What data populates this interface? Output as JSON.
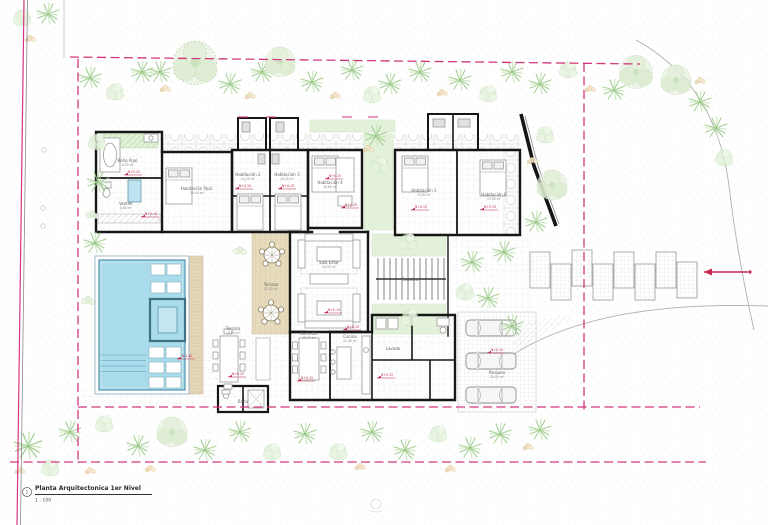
{
  "title_block": {
    "number": "1",
    "title": "Planta Arquitectonica 1er Nivel",
    "scale": "1 : 100"
  },
  "colors": {
    "boundary_pink": "#d2377e",
    "wall_black": "#161616",
    "pool_water": "#aadbea",
    "pool_edge": "#5d99b0",
    "vegetation_green": "#b3d6a3",
    "vegetation_light": "#ddeed3",
    "deck_wood": "#e6dabc",
    "marker_red": "#c42a4d",
    "furniture_gray": "#9b9b9b",
    "tile_gray": "#dedede"
  },
  "plan": {
    "rooms": [
      {
        "name": "Baño Ppal.",
        "area": "6.20 m²",
        "x": 128,
        "y": 162
      },
      {
        "name": "Vestier",
        "area": "4.80 m²",
        "x": 126,
        "y": 205
      },
      {
        "name": "Habitación Ppal.",
        "area": "18.40 m²",
        "x": 197,
        "y": 190
      },
      {
        "name": "Habitación 2",
        "area": "14.25 m²",
        "x": 248,
        "y": 176
      },
      {
        "name": "Habitación 3",
        "area": "14.25 m²",
        "x": 287,
        "y": 176
      },
      {
        "name": "Habitación 4",
        "area": "16.80 m²",
        "x": 330,
        "y": 184
      },
      {
        "name": "Habitación 5",
        "area": "15.60 m²",
        "x": 424,
        "y": 192
      },
      {
        "name": "Habitación 6",
        "area": "15.60 m²",
        "x": 494,
        "y": 196
      },
      {
        "name": "Sala Estar",
        "area": "24.50 m²",
        "x": 329,
        "y": 264
      },
      {
        "name": "Terraza",
        "area": "12.30 m²",
        "x": 271,
        "y": 286
      },
      {
        "name": "Comedor",
        "area": "15.70 m²",
        "x": 309,
        "y": 335
      },
      {
        "name": "Cocina",
        "area": "11.40 m²",
        "x": 350,
        "y": 338
      },
      {
        "name": "Lavado",
        "area": "",
        "x": 393,
        "y": 350
      },
      {
        "name": "Escalera",
        "area": "",
        "x": 410,
        "y": 281
      },
      {
        "name": "Terraza",
        "area": "18.60 m²",
        "x": 233,
        "y": 330
      },
      {
        "name": "Parqueo",
        "area": "32.00 m²",
        "x": 497,
        "y": 374
      },
      {
        "name": "Baño",
        "area": "",
        "x": 243,
        "y": 403
      }
    ],
    "markers": [
      {
        "label": "N+0.15",
        "x": 133,
        "y": 174
      },
      {
        "label": "N+0.15",
        "x": 150,
        "y": 216
      },
      {
        "label": "N+0.15",
        "x": 244,
        "y": 188
      },
      {
        "label": "N+0.15",
        "x": 287,
        "y": 188
      },
      {
        "label": "N+0.15",
        "x": 350,
        "y": 207
      },
      {
        "label": "N+0.15",
        "x": 420,
        "y": 209
      },
      {
        "label": "N+0.15",
        "x": 489,
        "y": 209
      },
      {
        "label": "N+0.15",
        "x": 334,
        "y": 178
      },
      {
        "label": "N+0.15",
        "x": 333,
        "y": 312
      },
      {
        "label": "N+0.15",
        "x": 352,
        "y": 329
      },
      {
        "label": "N+0.15",
        "x": 306,
        "y": 380
      },
      {
        "label": "N+0.15",
        "x": 237,
        "y": 376
      },
      {
        "label": "N+0.15",
        "x": 386,
        "y": 377
      },
      {
        "label": "N+0.10",
        "x": 496,
        "y": 352
      },
      {
        "label": "N-1.40",
        "x": 186,
        "y": 358
      }
    ]
  }
}
